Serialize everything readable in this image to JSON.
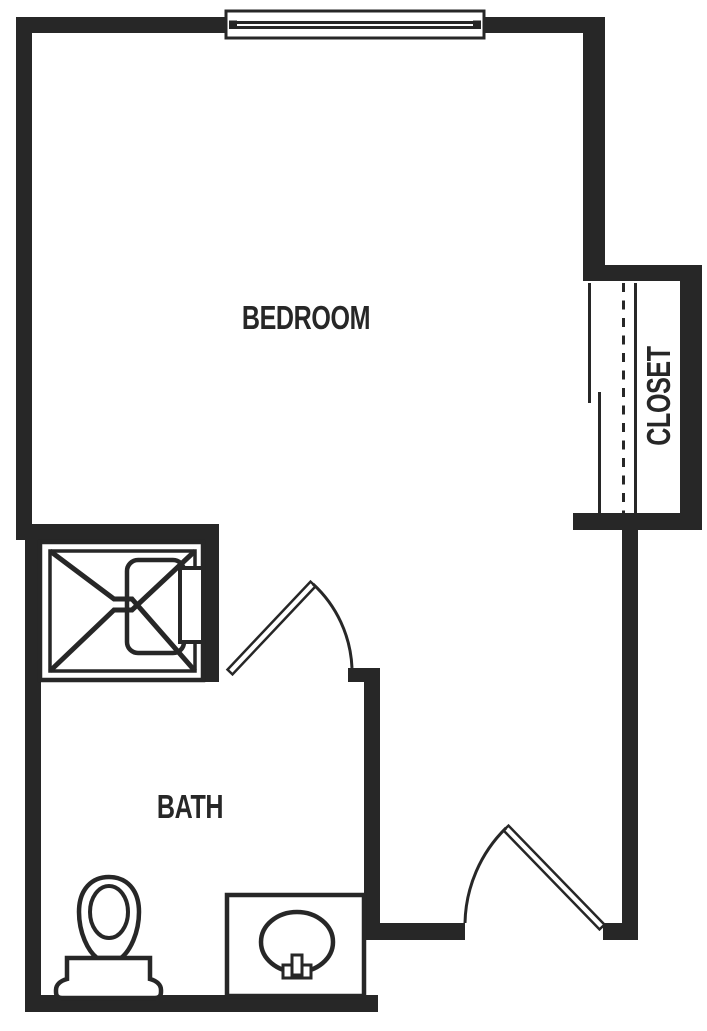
{
  "theme": {
    "background": "#ffffff",
    "wall_color": "#272727",
    "line_color": "#272727",
    "label_color": "#272727"
  },
  "floor_plan": {
    "rooms": [
      {
        "id": "bedroom",
        "label": "BEDROOM"
      },
      {
        "id": "bath",
        "label": "BATH"
      },
      {
        "id": "closet",
        "label": "CLOSET"
      }
    ],
    "fixtures": [
      {
        "name": "window",
        "room": "bedroom"
      },
      {
        "name": "bypass-doors",
        "room": "closet"
      },
      {
        "name": "hanging-rod",
        "room": "closet"
      },
      {
        "name": "shelf",
        "room": "closet"
      },
      {
        "name": "shower",
        "room": "bath"
      },
      {
        "name": "swing-door",
        "room": "bath"
      },
      {
        "name": "toilet",
        "room": "bath"
      },
      {
        "name": "sink-vanity",
        "room": "bath"
      },
      {
        "name": "entry-swing-door",
        "room": "bedroom"
      }
    ]
  }
}
